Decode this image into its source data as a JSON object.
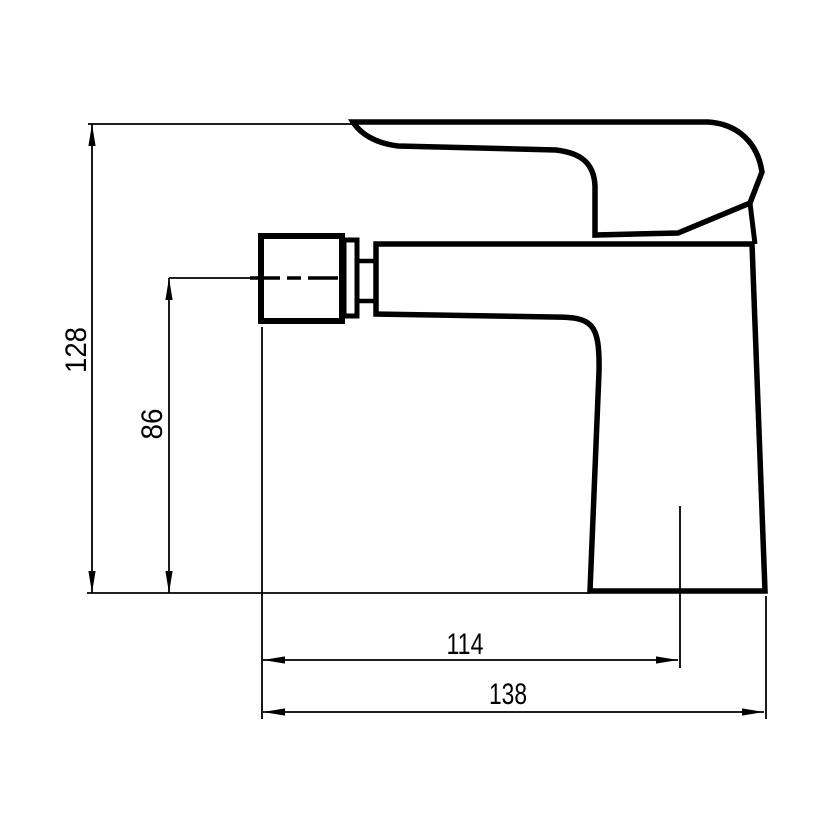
{
  "drawing": {
    "kind": "technical-dimension-drawing",
    "subject": "single-lever mixer faucet, side view",
    "background_color": "#ffffff",
    "line_color": "#000000"
  },
  "dimensions": [
    {
      "id": "overall-height",
      "value": "128",
      "orientation": "vertical"
    },
    {
      "id": "spout-height",
      "value": "86",
      "orientation": "vertical"
    },
    {
      "id": "reach-to-center",
      "value": "114",
      "orientation": "horizontal"
    },
    {
      "id": "overall-reach",
      "value": "138",
      "orientation": "horizontal"
    }
  ]
}
